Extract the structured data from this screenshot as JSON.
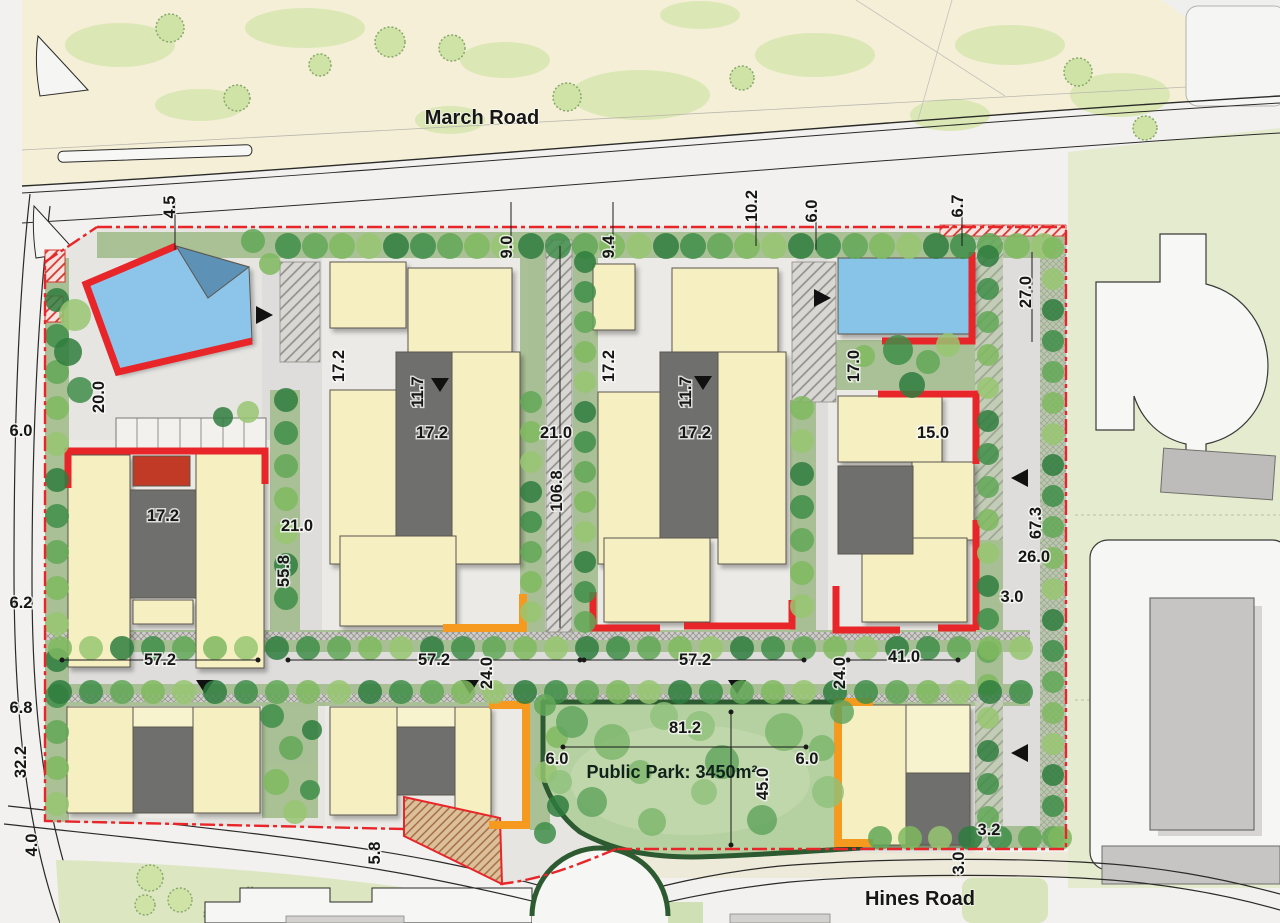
{
  "roads": {
    "march": "March Road",
    "hines": "Hines Road"
  },
  "park": {
    "label": "Public Park: 3450m²"
  },
  "colors": {
    "boundary_red": "#e8262a",
    "highlight_orange": "#f5991f",
    "building_yellow": "#f5efc2",
    "landmark_blue": "#8cc5e9",
    "courtyard_gray": "#6f6f6d",
    "park_green": "#b6d1a1",
    "park_border": "#2d5a30"
  },
  "dimensions": [
    {
      "v": "4.5",
      "x": 175,
      "y": 207,
      "r": -90
    },
    {
      "v": "9.0",
      "x": 512,
      "y": 247,
      "r": -90
    },
    {
      "v": "9.4",
      "x": 614,
      "y": 247,
      "r": -90
    },
    {
      "v": "10.2",
      "x": 757,
      "y": 206,
      "r": -90
    },
    {
      "v": "6.0",
      "x": 817,
      "y": 211,
      "r": -90
    },
    {
      "v": "6.7",
      "x": 963,
      "y": 206,
      "r": -90
    },
    {
      "v": "27.0",
      "x": 1031,
      "y": 292,
      "r": -90
    },
    {
      "v": "20.0",
      "x": 104,
      "y": 397,
      "r": -90
    },
    {
      "v": "17.2",
      "x": 344,
      "y": 366,
      "r": -90
    },
    {
      "v": "11.7",
      "x": 423,
      "y": 392,
      "r": -90
    },
    {
      "v": "17.2",
      "x": 614,
      "y": 366,
      "r": -90
    },
    {
      "v": "11.7",
      "x": 691,
      "y": 392,
      "r": -90
    },
    {
      "v": "17.0",
      "x": 859,
      "y": 366,
      "r": -90
    },
    {
      "v": "6.0",
      "x": 21,
      "y": 436,
      "r": 0
    },
    {
      "v": "17.2",
      "x": 432,
      "y": 438,
      "r": 0
    },
    {
      "v": "21.0",
      "x": 556,
      "y": 438,
      "r": 0
    },
    {
      "v": "17.2",
      "x": 695,
      "y": 438,
      "r": 0
    },
    {
      "v": "15.0",
      "x": 933,
      "y": 438,
      "r": 0
    },
    {
      "v": "106.8",
      "x": 562,
      "y": 491,
      "r": -90
    },
    {
      "v": "17.2",
      "x": 163,
      "y": 521,
      "r": 0
    },
    {
      "v": "21.0",
      "x": 297,
      "y": 531,
      "r": 0
    },
    {
      "v": "55.8",
      "x": 289,
      "y": 571,
      "r": -90
    },
    {
      "v": "67.3",
      "x": 1041,
      "y": 523,
      "r": -90
    },
    {
      "v": "26.0",
      "x": 1034,
      "y": 562,
      "r": 0
    },
    {
      "v": "3.0",
      "x": 1012,
      "y": 602,
      "r": 0
    },
    {
      "v": "6.2",
      "x": 21,
      "y": 608,
      "r": 0
    },
    {
      "v": "57.2",
      "x": 160,
      "y": 665,
      "r": 0
    },
    {
      "v": "57.2",
      "x": 434,
      "y": 665,
      "r": 0
    },
    {
      "v": "24.0",
      "x": 492,
      "y": 673,
      "r": -90
    },
    {
      "v": "57.2",
      "x": 695,
      "y": 665,
      "r": 0
    },
    {
      "v": "24.0",
      "x": 845,
      "y": 673,
      "r": -90
    },
    {
      "v": "41.0",
      "x": 904,
      "y": 662,
      "r": 0
    },
    {
      "v": "6.8",
      "x": 21,
      "y": 713,
      "r": 0
    },
    {
      "v": "32.2",
      "x": 26,
      "y": 762,
      "r": -90
    },
    {
      "v": "81.2",
      "x": 685,
      "y": 733,
      "r": 0
    },
    {
      "v": "6.0",
      "x": 557,
      "y": 764,
      "r": 0
    },
    {
      "v": "45.0",
      "x": 768,
      "y": 784,
      "r": -90
    },
    {
      "v": "6.0",
      "x": 807,
      "y": 764,
      "r": 0
    },
    {
      "v": "4.0",
      "x": 37,
      "y": 845,
      "r": -90
    },
    {
      "v": "5.8",
      "x": 380,
      "y": 853,
      "r": -90
    },
    {
      "v": "3.2",
      "x": 989,
      "y": 835,
      "r": 0
    },
    {
      "v": "3.0",
      "x": 964,
      "y": 863,
      "r": -90
    }
  ]
}
